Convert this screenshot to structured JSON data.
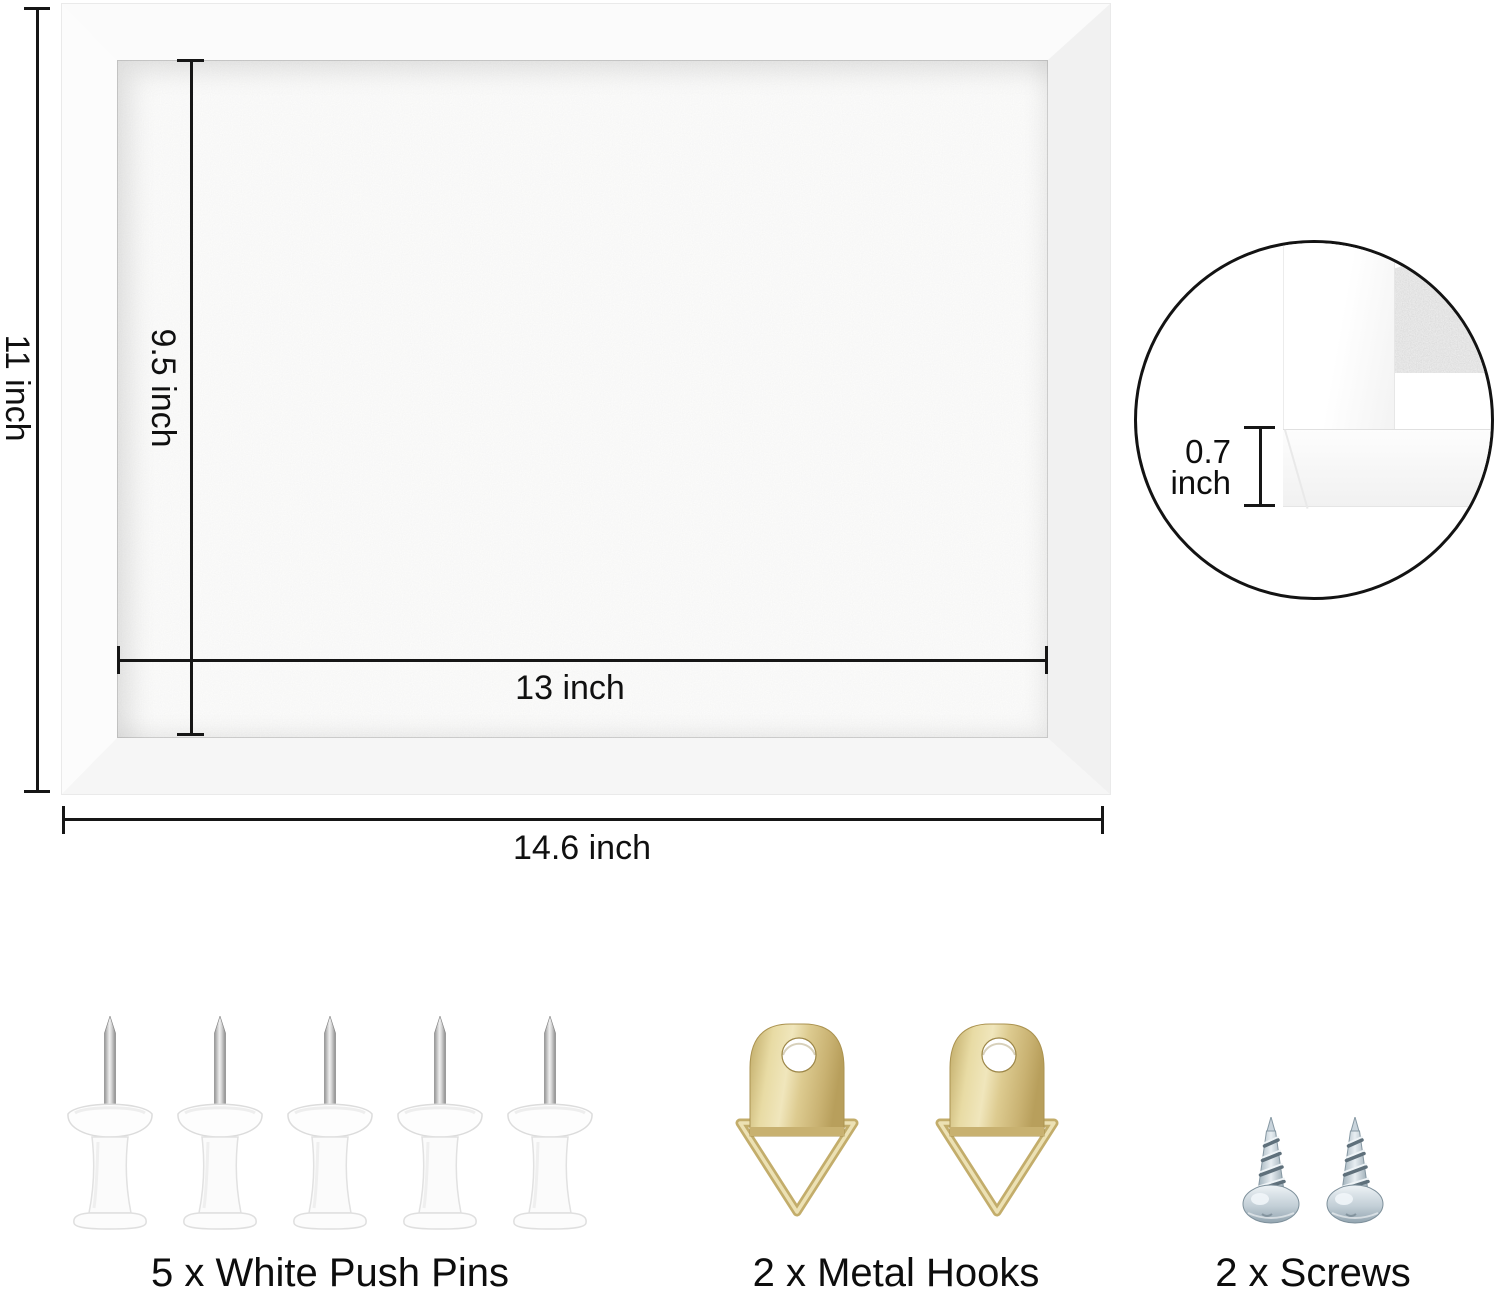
{
  "dimensions": {
    "outer_height": "11 inch",
    "inner_height": "9.5 inch",
    "inner_width": "13 inch",
    "outer_width": "14.6 inch",
    "thickness_value": "0.7",
    "thickness_unit": "inch"
  },
  "detail_inset": {
    "description": "frame-corner-profile-closeup"
  },
  "accessories": [
    {
      "id": "push-pins",
      "icon": "push-pin-icon",
      "count": 5,
      "label": "5 x White Push Pins"
    },
    {
      "id": "metal-hooks",
      "icon": "metal-hook-icon",
      "count": 2,
      "label": "2 x Metal Hooks"
    },
    {
      "id": "screws",
      "icon": "screw-icon",
      "count": 2,
      "label": "2 x Screws"
    }
  ],
  "colors": {
    "dimension_line": "#161616",
    "text": "#101010",
    "frame_white": "#fbfbfb",
    "felt_light": "#f0f0ef",
    "felt_edge_gray": "#c9c9c9",
    "hook_gold": "#d9c88c",
    "screw_silver": "#c3cfd7",
    "pin_white": "#fcfcfc"
  }
}
